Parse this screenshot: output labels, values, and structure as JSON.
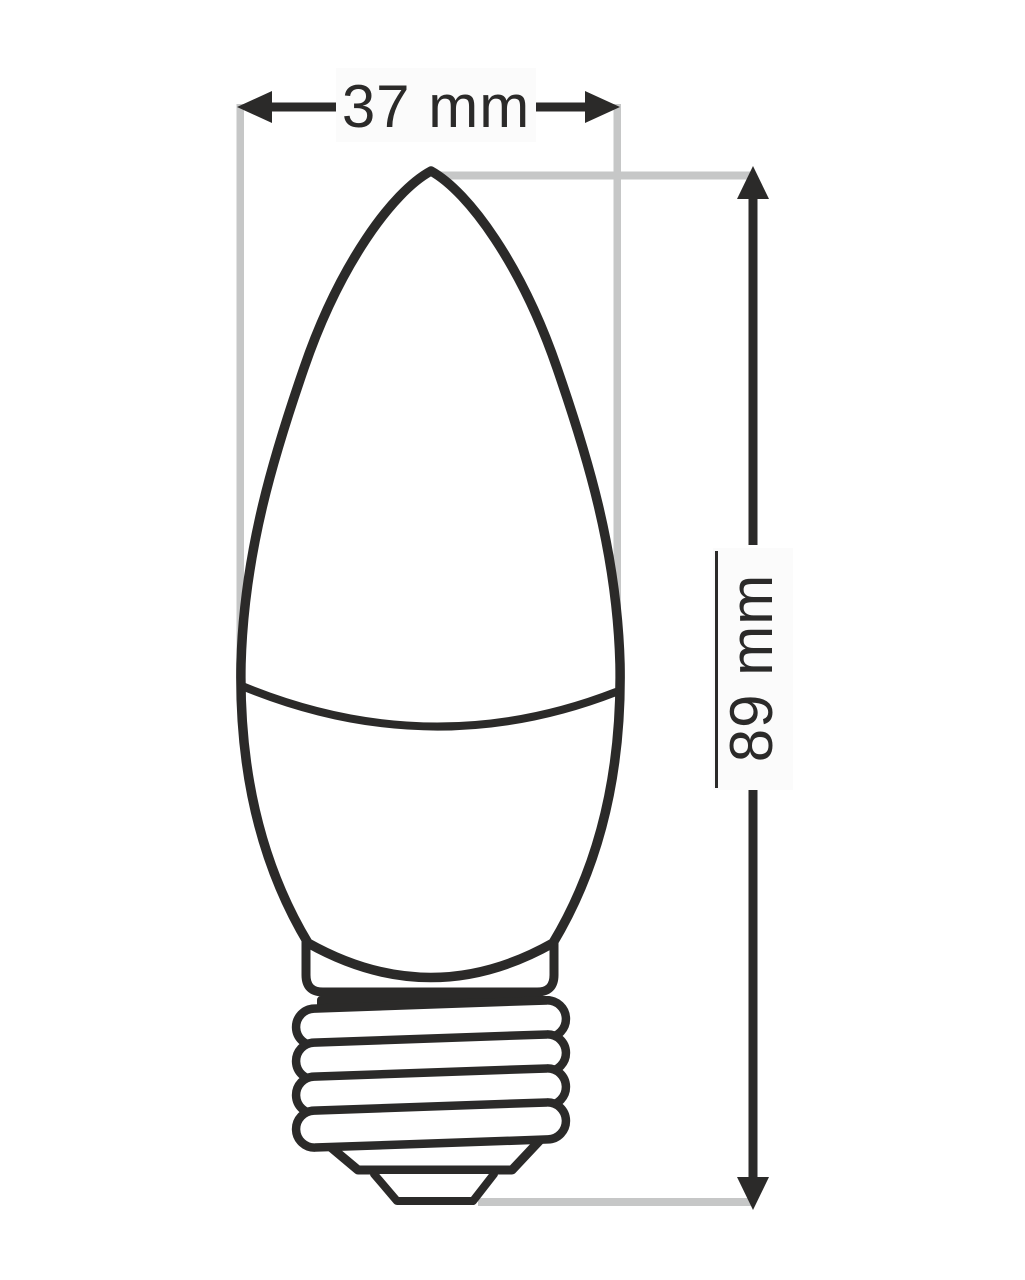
{
  "diagram": {
    "name": "led-candle-bulb-dimension-drawing",
    "width_dimension": {
      "label": "37 mm"
    },
    "height_dimension": {
      "label": "89 mm"
    }
  },
  "colors": {
    "outline": "#2b2a29",
    "guide": "#c6c7c7",
    "label-bg": "#fbfbfb",
    "fill": "#ffffff"
  }
}
